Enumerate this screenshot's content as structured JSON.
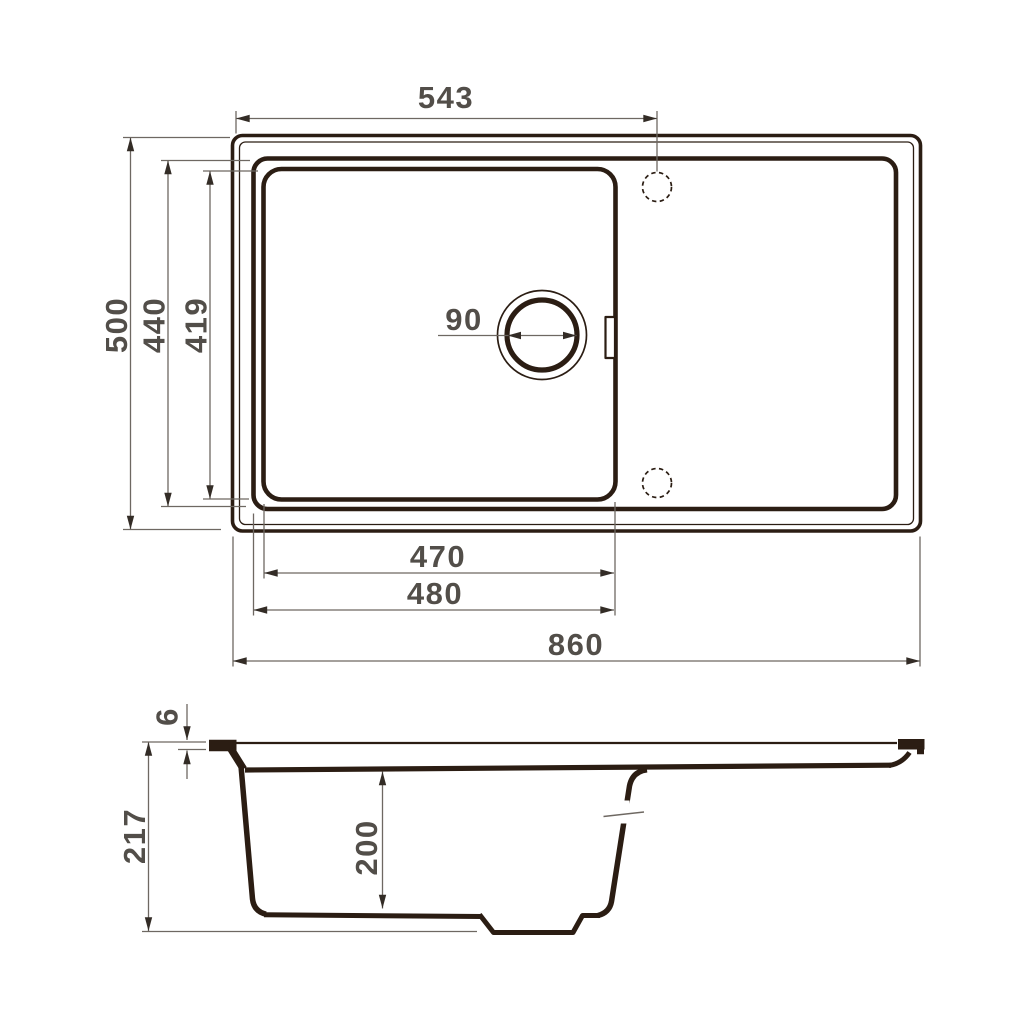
{
  "colors": {
    "line": "#2b1d13",
    "dim_line": "#6e6862",
    "arrow": "#332c26",
    "text": "#524e49",
    "background": "#ffffff"
  },
  "views": {
    "top_view": {
      "name": "sink top view",
      "dims": {
        "rim_to_tap_center": "543",
        "overall_depth": "500",
        "bowl_outer_depth": "440",
        "bowl_inner_depth": "419",
        "drain_diameter": "90",
        "bowl_inner_width": "470",
        "bowl_outer_width": "480",
        "overall_width": "860"
      }
    },
    "section_view": {
      "name": "sink section view",
      "dims": {
        "rim_thickness": "6",
        "overall_height": "217",
        "bowl_depth": "200"
      }
    }
  }
}
